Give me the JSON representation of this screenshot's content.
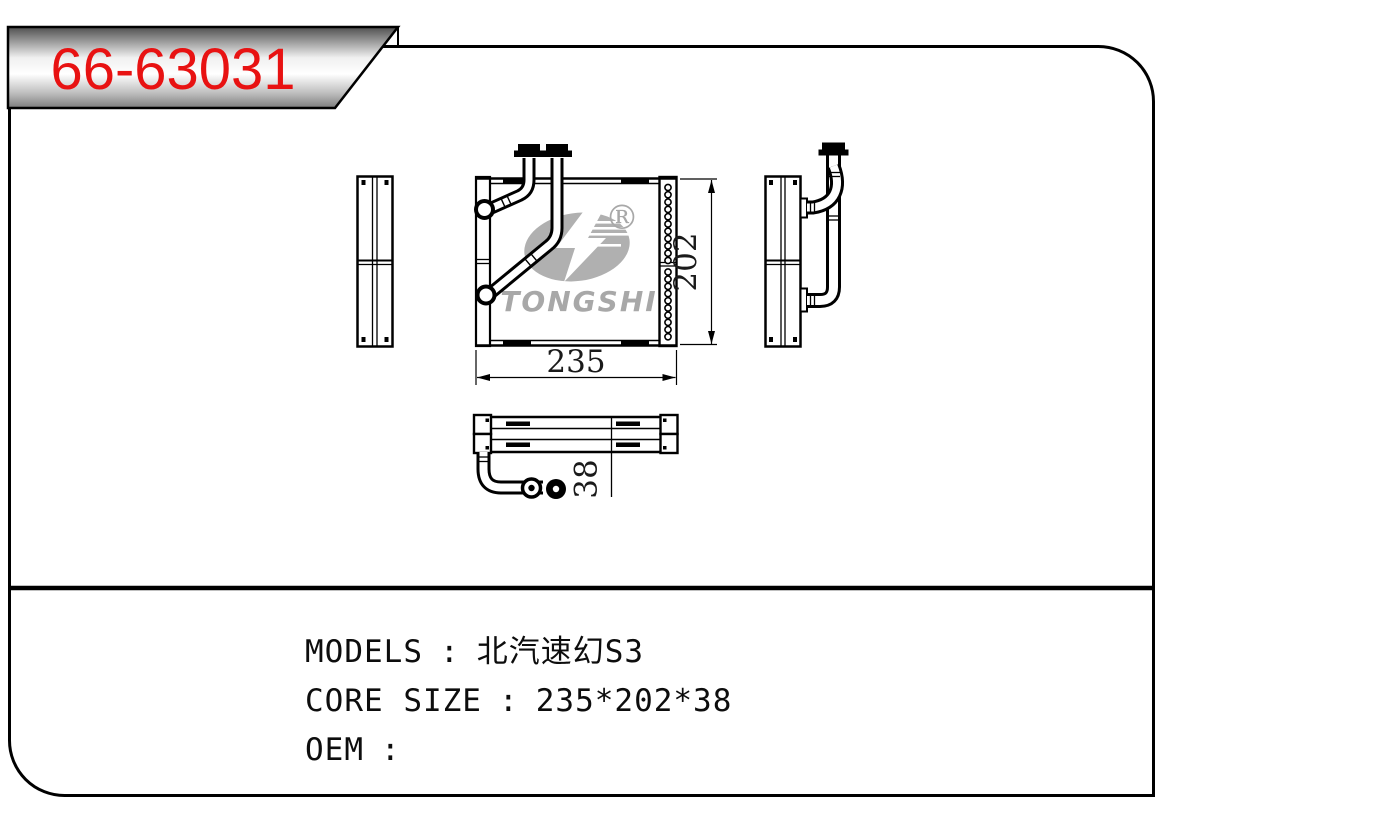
{
  "badge": {
    "part_number": "66-63031",
    "text_color": "#e81212"
  },
  "watermark": {
    "brand": "TONGSHI",
    "registered_mark": "®",
    "color": "#b0b0b0",
    "text_color": "#a8a8a8"
  },
  "drawing": {
    "dimensions": {
      "width": "235",
      "height": "202",
      "depth": "38"
    }
  },
  "info": {
    "separator": ":",
    "rows": [
      {
        "label": "MODELS",
        "value": "北汽速幻S3"
      },
      {
        "label": "CORE SIZE",
        "value": "235*202*38"
      },
      {
        "label": "OEM",
        "value": ""
      }
    ]
  }
}
